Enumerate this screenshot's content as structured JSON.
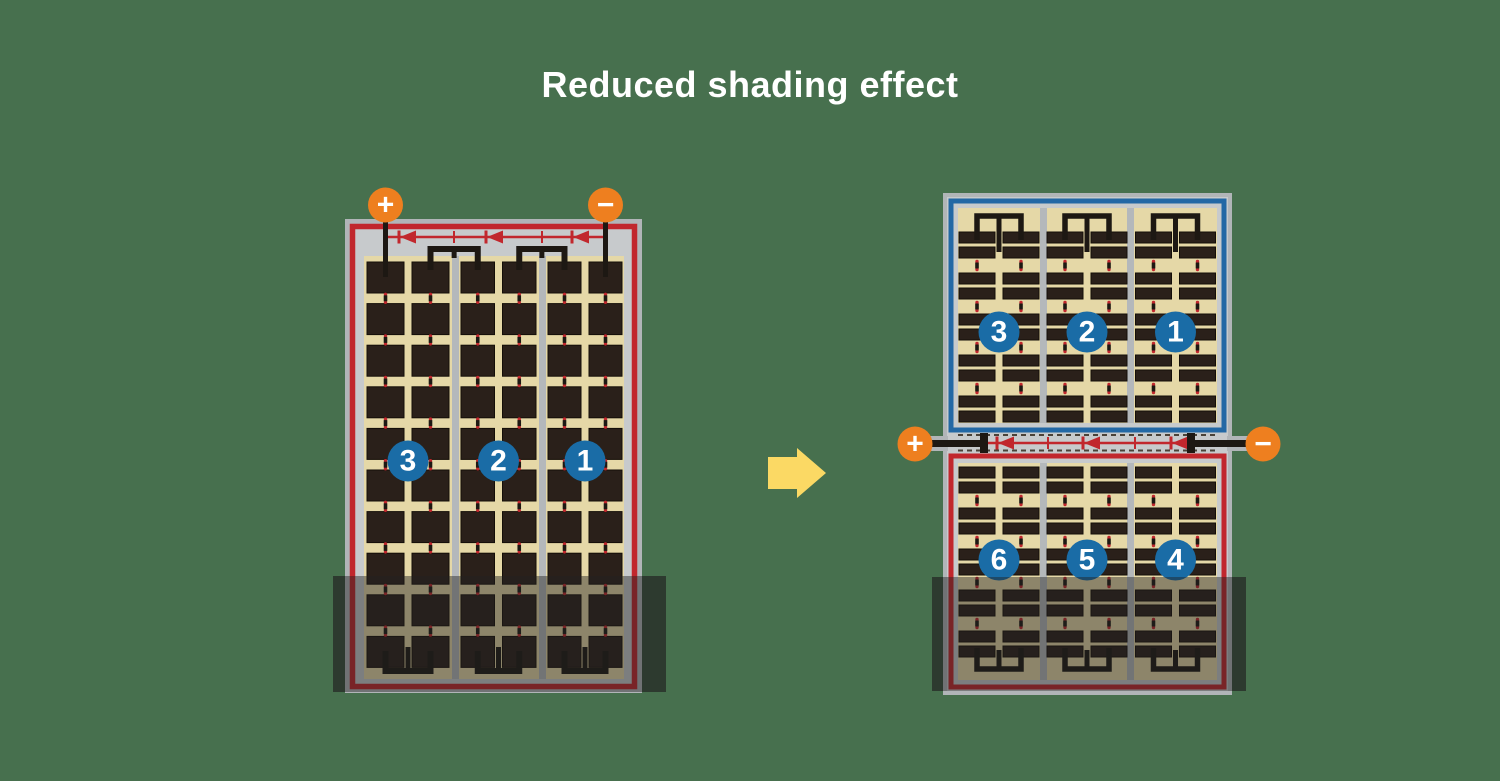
{
  "title": "Reduced shading effect",
  "colors": {
    "background": "#47704E",
    "frame_gray": "#b1b5b8",
    "inner_gray": "#c7cacc",
    "cell_tan": "#e5d8a7",
    "cell_dark": "#2a201a",
    "cell_stroke": "#140e08",
    "separator_gray": "#b4b8bb",
    "wire_black": "#1d1813",
    "circuit_red": "#c1272d",
    "circuit_blue": "#2368a5",
    "terminal_orange": "#ee7f1f",
    "number_circle_blue": "#1a6ca6",
    "arrow_yellow": "#fbd964",
    "shade": "rgba(33,33,33,0.45)",
    "shade_edge": "rgba(33,33,33,0.4)",
    "text_white": "#ffffff"
  },
  "left_panel": {
    "diode_count": 3,
    "terminals": {
      "plus": "+",
      "minus": "−"
    },
    "section_circles": [
      "3",
      "2",
      "1"
    ]
  },
  "right_panel": {
    "diode_count": 3,
    "terminals": {
      "plus": "+",
      "minus": "−"
    },
    "top_section_circles": [
      "3",
      "2",
      "1"
    ],
    "bottom_section_circles": [
      "6",
      "5",
      "4"
    ]
  }
}
